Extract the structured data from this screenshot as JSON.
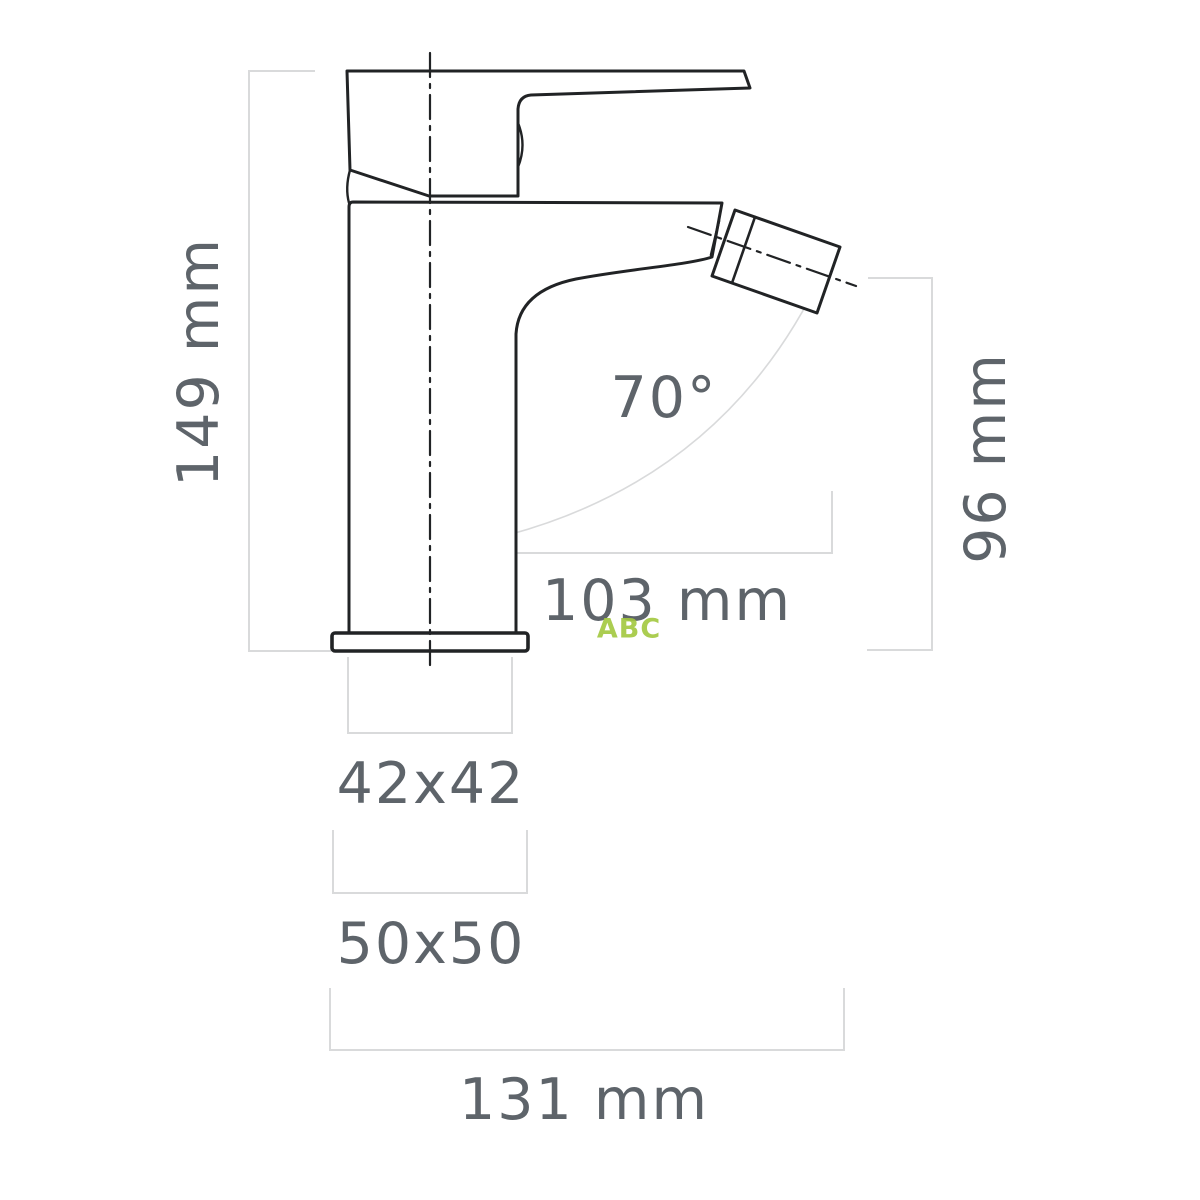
{
  "drawing": {
    "type": "technical-dimension-drawing",
    "subject": "bidet mixer tap - side view",
    "labels": {
      "overall_height": "149 mm",
      "spout_angle": "70°",
      "spout_outlet_height": "96 mm",
      "spout_reach": "103 mm",
      "body_section": "42x42",
      "base_section": "50x50",
      "overall_depth": "131 mm"
    },
    "watermark": "ABC",
    "colors": {
      "outline": "#212325",
      "dimension_line": "#d9dadb",
      "dimension_text": "#5e646a",
      "watermark_green": "#a3c83f",
      "background": "#ffffff"
    }
  }
}
